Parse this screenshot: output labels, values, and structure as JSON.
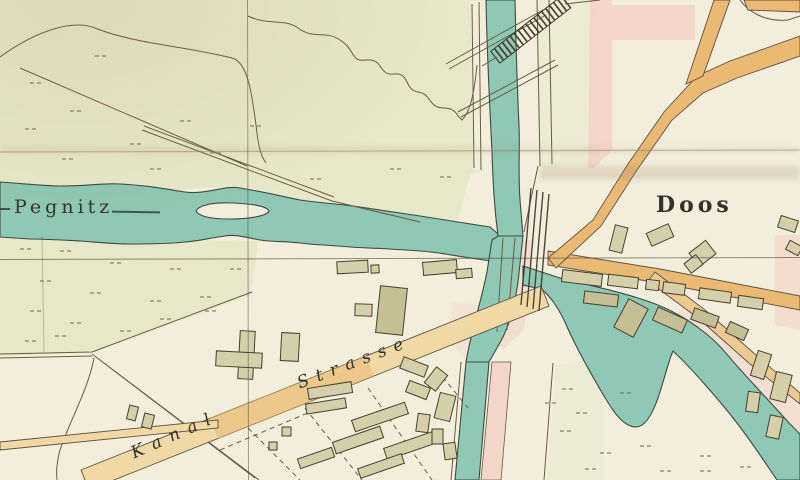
{
  "map": {
    "labels": {
      "river": "Pegnitz",
      "town": "Doos",
      "street_word1": "Kanal",
      "street_word2": "Strasse"
    },
    "colors": {
      "paper": "#f3eedc",
      "meadow": "#e6e8c9",
      "water": "#8fc8b4",
      "waterline": "#3c4a40",
      "roadtan": "#f0d9a5",
      "roadorange": "#eaba74",
      "pink": "#f3cfc5",
      "building": "#d6d0aa",
      "building2": "#c6be95",
      "outline": "#46402f",
      "inkline": "#6a5b43",
      "label": "#32342c",
      "grid": "#4d4435"
    }
  }
}
